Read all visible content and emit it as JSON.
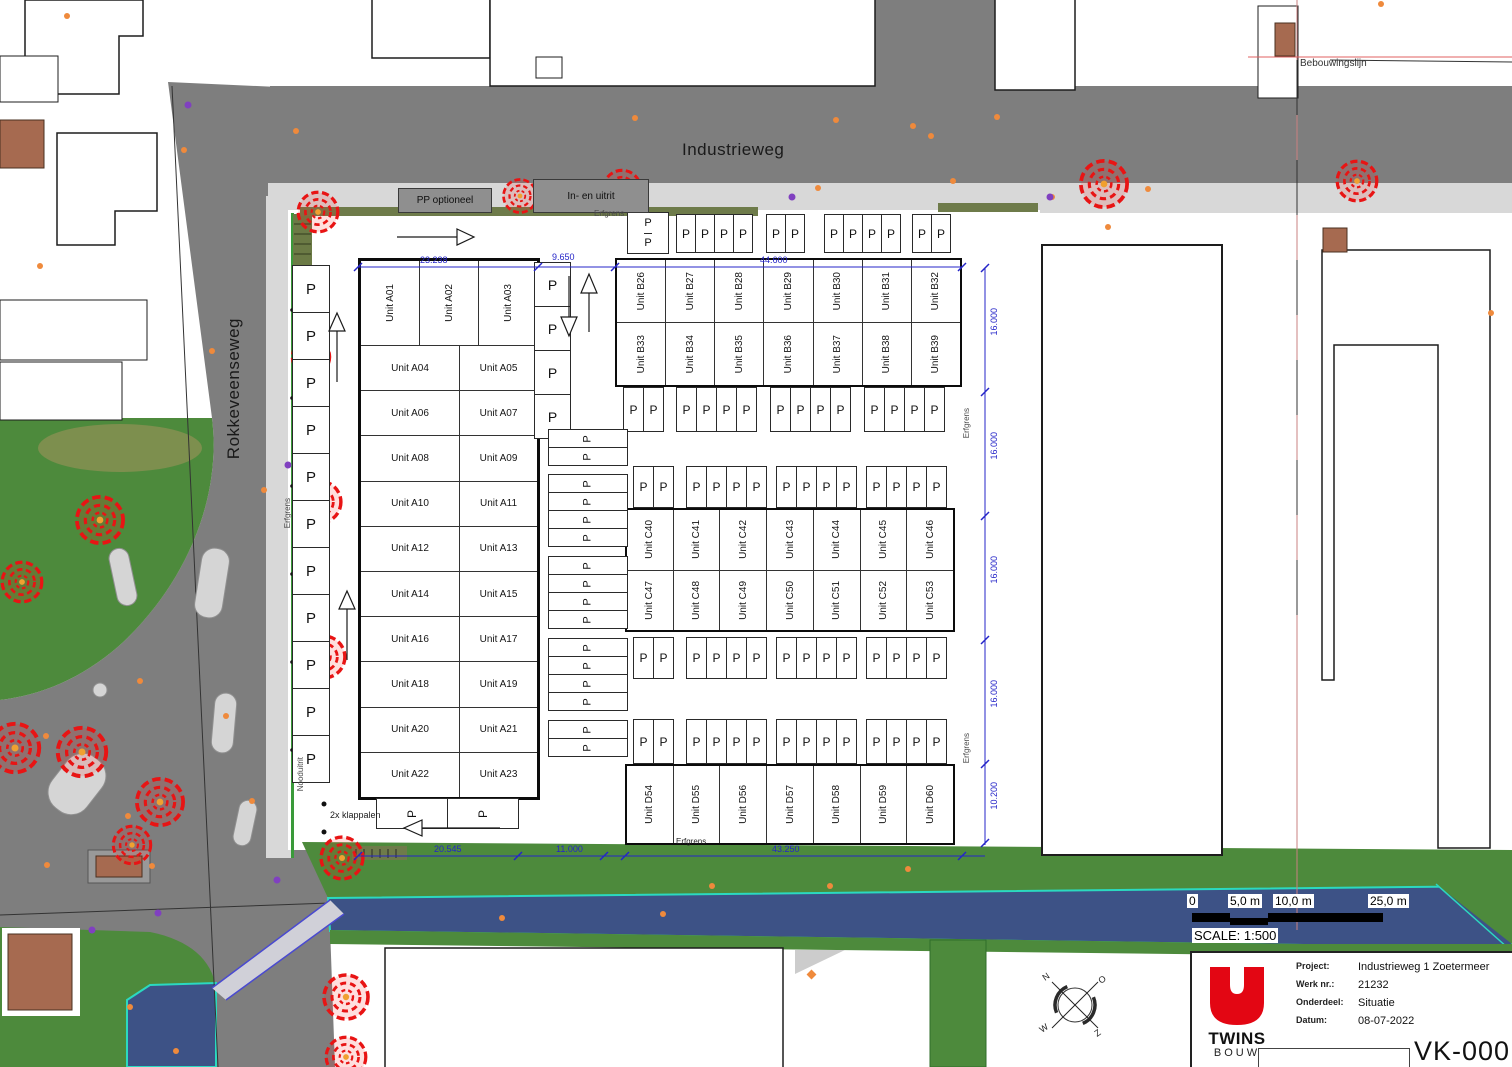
{
  "drawing": {
    "roads": {
      "industrieweg": "Industrieweg",
      "rokkeveenseweg": "Rokkeveenseweg"
    },
    "annotations": {
      "bebouwingslijn": "Bebouwingslijn",
      "pp_optioneel": "PP optioneel",
      "in_en_uitrit": "In- en uitrit",
      "erfgrens": "Erfgrens",
      "klappalen": "2x klappalen",
      "nooduitrit": "Nooduitrit"
    },
    "parking_letter": "P",
    "dimensions": {
      "a_width": "23.238",
      "gap": "9.650",
      "b_width": "44.600",
      "right": [
        "16.000",
        "16.000",
        "16.000",
        "16.000",
        "10.200"
      ],
      "bottom": [
        "20.545",
        "11.000",
        "43.250"
      ]
    },
    "blocks": {
      "a_top": [
        "Unit A01",
        "Unit A02",
        "Unit A03"
      ],
      "a_rows": [
        [
          "Unit A04",
          "Unit A05"
        ],
        [
          "Unit A06",
          "Unit A07"
        ],
        [
          "Unit A08",
          "Unit A09"
        ],
        [
          "Unit A10",
          "Unit A11"
        ],
        [
          "Unit A12",
          "Unit A13"
        ],
        [
          "Unit A14",
          "Unit A15"
        ],
        [
          "Unit A16",
          "Unit A17"
        ],
        [
          "Unit A18",
          "Unit A19"
        ],
        [
          "Unit A20",
          "Unit A21"
        ],
        [
          "Unit A22",
          "Unit A23"
        ]
      ],
      "b_rows": [
        [
          "Unit B26",
          "Unit B27",
          "Unit B28",
          "Unit B29",
          "Unit B30",
          "Unit B31",
          "Unit B32"
        ],
        [
          "Unit B33",
          "Unit B34",
          "Unit B35",
          "Unit B36",
          "Unit B37",
          "Unit B38",
          "Unit B39"
        ]
      ],
      "c_rows": [
        [
          "Unit C40",
          "Unit C41",
          "Unit C42",
          "Unit C43",
          "Unit C44",
          "Unit C45",
          "Unit C46"
        ],
        [
          "Unit C47",
          "Unit C48",
          "Unit C49",
          "Unit C50",
          "Unit C51",
          "Unit C52",
          "Unit C53"
        ]
      ],
      "d_row": [
        "Unit D54",
        "Unit D55",
        "Unit D56",
        "Unit D57",
        "Unit D58",
        "Unit D59",
        "Unit D60"
      ]
    },
    "compass": {
      "n": "N",
      "e": "O",
      "s": "Z",
      "w": "W"
    },
    "scale_bar": {
      "ticks": [
        "0",
        "5,0 m",
        "10,0 m",
        "25,0 m"
      ],
      "label": "SCALE: 1:500"
    },
    "title_block": {
      "logo_title": "TWINS",
      "logo_sub": "BOUW",
      "logo_color": "#e30613",
      "fields": [
        {
          "label": "Project:",
          "value": "Industrieweg 1 Zoetermeer"
        },
        {
          "label": "Werk nr.:",
          "value": "21232"
        },
        {
          "label": "Onderdeel:",
          "value": "Situatie"
        },
        {
          "label": "Datum:",
          "value": "08-07-2022"
        }
      ],
      "drawing_number": "VK-000"
    }
  }
}
